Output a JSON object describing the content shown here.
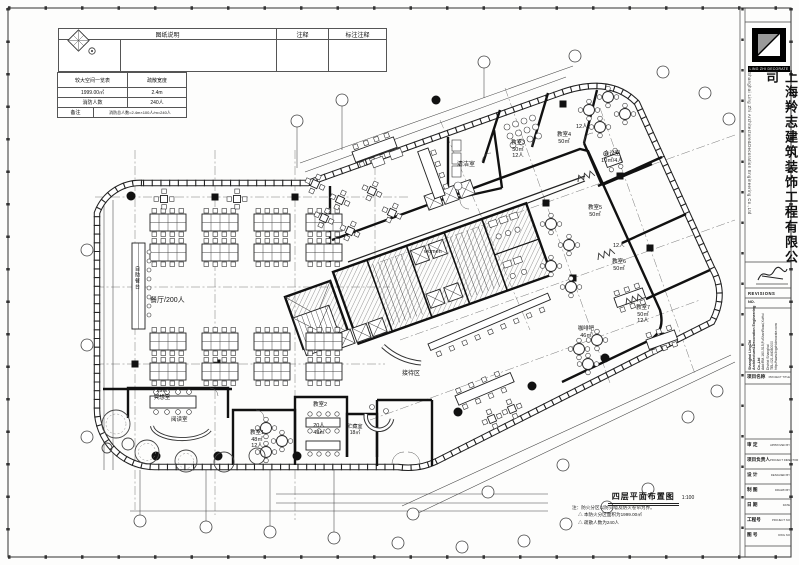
{
  "sheet": {
    "legend": {
      "col1": "图纸说明",
      "col2": "注释",
      "col3": "标注注释"
    },
    "fire_table": {
      "rows": [
        [
          "较大空间一览表",
          "疏散宽度"
        ],
        [
          "1999.00㎡",
          "2.4m"
        ],
        [
          "消防人数",
          "240人"
        ],
        [
          "备注",
          "消防总人数=2.4m×100人/m=240人"
        ]
      ]
    },
    "title": "四层平面布置图",
    "scale": "1:100",
    "notes": [
      "注：防火分区以防火墙及防火卷帘为界。",
      "△ 本防火分区面积为1999.00㎡",
      "△ 疏散人数为240人"
    ]
  },
  "plan": {
    "labels": {
      "canteen": "餐厅/200人",
      "buffet": "自助餐台",
      "clean": "清洁室",
      "women": "women",
      "reception": "接待区",
      "reading": "阅读室",
      "meditation_area": "29㎡",
      "meditation": "冥想室",
      "cafe": "咖啡吧",
      "cafe_area": "46㎡",
      "cls1": "教室1",
      "cls1_area": "48㎡",
      "cls1_cap": "12人",
      "cls2": "教室2",
      "cls2_cap": "20人",
      "cls2_area": "43㎡",
      "storage": "贮藏室",
      "storage_area": "18㎡",
      "cls3": "教室3",
      "cls3_area": "50㎡",
      "cls3_cap": "12人",
      "cls4": "教室4",
      "cls4_area": "50㎡",
      "cls4_cap": "12人",
      "meeting": "会议室",
      "meeting_spec": "10㎡/4人",
      "cls5": "教室5",
      "cls5_area": "50㎡",
      "cls5_cap": "12人",
      "cls6": "教室6",
      "cls6_area": "50㎡",
      "cls7": "教室7",
      "cls7_area": "50㎡",
      "cls7_cap": "12人"
    }
  },
  "titleblock": {
    "logo_caption": "LING ZHI DECORATE",
    "company_cn": "上海羚志建筑装饰工程有限公司",
    "company_en": "Shanghai Ling Zhi Architecture&Decoration Engineering Co.,Ltd",
    "revisions": "REVISIONS",
    "no_label": "NO.",
    "address": {
      "name": "Shanghai LingZhi Architecture&Decoration Engineering Co.,Ltd",
      "line1": "Add:RM.160-515,FuShanRoad,XuHui District Shanghai",
      "tel": "TEL:021-64080000",
      "web": "http://www.lingzhidecorate.com"
    },
    "rows": [
      {
        "cn": "项目名称",
        "en": "PROJECT TITLE"
      },
      {
        "cn": "审 定",
        "en": "APPROVED BY"
      },
      {
        "cn": "项目负责人",
        "en": "PROJECT DIRECTOR"
      },
      {
        "cn": "设 计",
        "en": "DESIGNED BY"
      },
      {
        "cn": "制 图",
        "en": "DRAWN BY"
      },
      {
        "cn": "日 期",
        "en": "DATE"
      },
      {
        "cn": "工程号",
        "en": "PROJECT NO"
      },
      {
        "cn": "图 号",
        "en": "DWG NO"
      }
    ]
  }
}
